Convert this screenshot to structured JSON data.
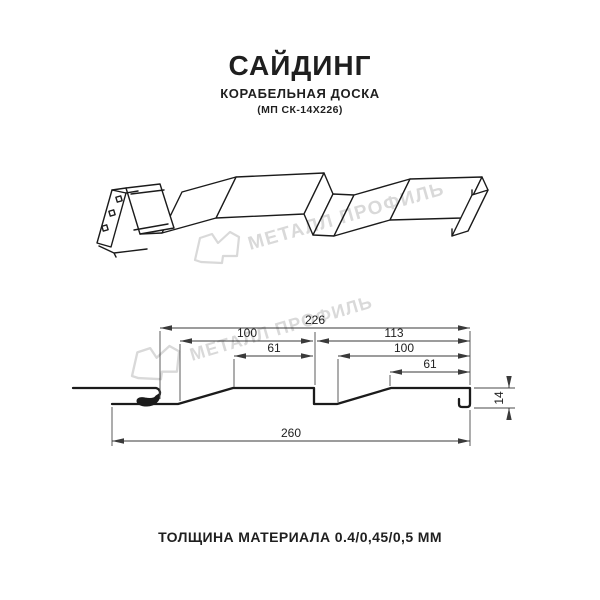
{
  "header": {
    "title": "САЙДИНГ",
    "subtitle": "КОРАБЕЛЬНАЯ ДОСКА",
    "model_code": "(МП СК-14Х226)"
  },
  "watermark": {
    "text": "МЕТАЛЛ ПРОФИЛЬ",
    "color": "#d9d9d9"
  },
  "cross_section": {
    "dimensions": {
      "overall_width_top": "226",
      "left_pitch": "100",
      "right_pitch": "113",
      "left_flat": "61",
      "right_inner": "100",
      "right_flat": "61",
      "overall_width_bottom": "260",
      "profile_height": "14"
    }
  },
  "footer": {
    "thickness_note": "ТОЛЩИНА МАТЕРИАЛА 0.4/0,45/0,5 ММ"
  },
  "colors": {
    "line_art": "#1b1b1b",
    "dimension_lines": "#3a3a3a",
    "watermark": "#d9d9d9",
    "text": "#1f1f1f"
  }
}
